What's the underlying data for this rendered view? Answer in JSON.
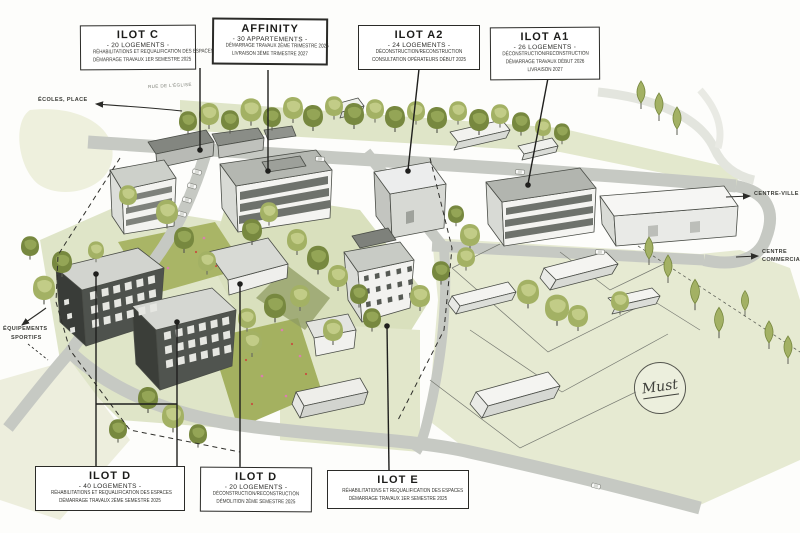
{
  "page": {
    "title": "Plan masse illustré du quartier"
  },
  "labels": {
    "ilot_c": {
      "title": "ILOT C",
      "subtitle": "- 20 LOGEMENTS -",
      "lines": [
        "RÉHABILITATIONS ET REQUALIFICATION DES ESPACES",
        "DÉMARRAGE TRAVAUX 1ER SEMESTRE 2025"
      ]
    },
    "affinity": {
      "title": "AFFINITY",
      "subtitle": "- 30 APPARTEMENTS -",
      "lines": [
        "DÉMARRAGE TRAVAUX 2ÈME TRIMESTRE 2025",
        "LIVRAISON 3ÈME TRIMESTRE 2027"
      ]
    },
    "ilot_a2": {
      "title": "ILOT A2",
      "subtitle": "- 24 LOGEMENTS -",
      "lines": [
        "DÉCONSTRUCTION/RECONSTRUCTION",
        "CONSULTATION OPÉRATEURS DÉBUT 2025"
      ]
    },
    "ilot_a1": {
      "title": "ILOT A1",
      "subtitle": "- 26 LOGEMENTS -",
      "lines": [
        "DÉCONSTRUCTION/RECONSTRUCTION",
        "DÉMARRAGE TRAVAUX DÉBUT 2026",
        "LIVRAISON 2027"
      ]
    },
    "ilot_d_ouest": {
      "title": "ILOT D",
      "subtitle": "- 40 LOGEMENTS -",
      "lines": [
        "RÉHABILITATIONS ET REQUALIFICATION DES ESPACES",
        "DÉMARRAGE TRAVAUX 2ÈME SEMESTRE 2025"
      ]
    },
    "ilot_d_est": {
      "title": "ILOT D",
      "subtitle": "- 20 LOGEMENTS -",
      "lines": [
        "DÉCONSTRUCTION/RECONSTRUCTION",
        "DÉMOLITION 2ÈME SEMESTRE 2025"
      ]
    },
    "ilot_e": {
      "title": "ILOT E",
      "lines": [
        "RÉHABILITATIONS ET REQUALIFICATION DES ESPACES",
        "DÉMARRAGE TRAVAUX 1ER SEMESTRE 2025"
      ]
    }
  },
  "annotations": {
    "ecoles_place": "ÉCOLES, PLACE",
    "rue_haut": "RUE DE L'ÉGLISE",
    "centre_ville": "CENTRE-VILLE",
    "centre_commercial_1": "CENTRE",
    "centre_commercial_2": "COMMERCIAL...",
    "equipements_1": "ÉQUIPEMENTS",
    "equipements_2": "SPORTIFS",
    "signature": "Must"
  },
  "palette": {
    "lawn": "#e6ead2",
    "meadow": "#a9b566",
    "tree_light": "#a3b164",
    "tree_dark": "#77883f",
    "road": "#c6c9c3",
    "facade_light": "#f4f4f1",
    "facade_dark": "#4e524d",
    "roof_grey": "#b4b7b1",
    "ink": "#26262a",
    "flower_pink": "#db7fae",
    "flower_red": "#c7503f"
  }
}
